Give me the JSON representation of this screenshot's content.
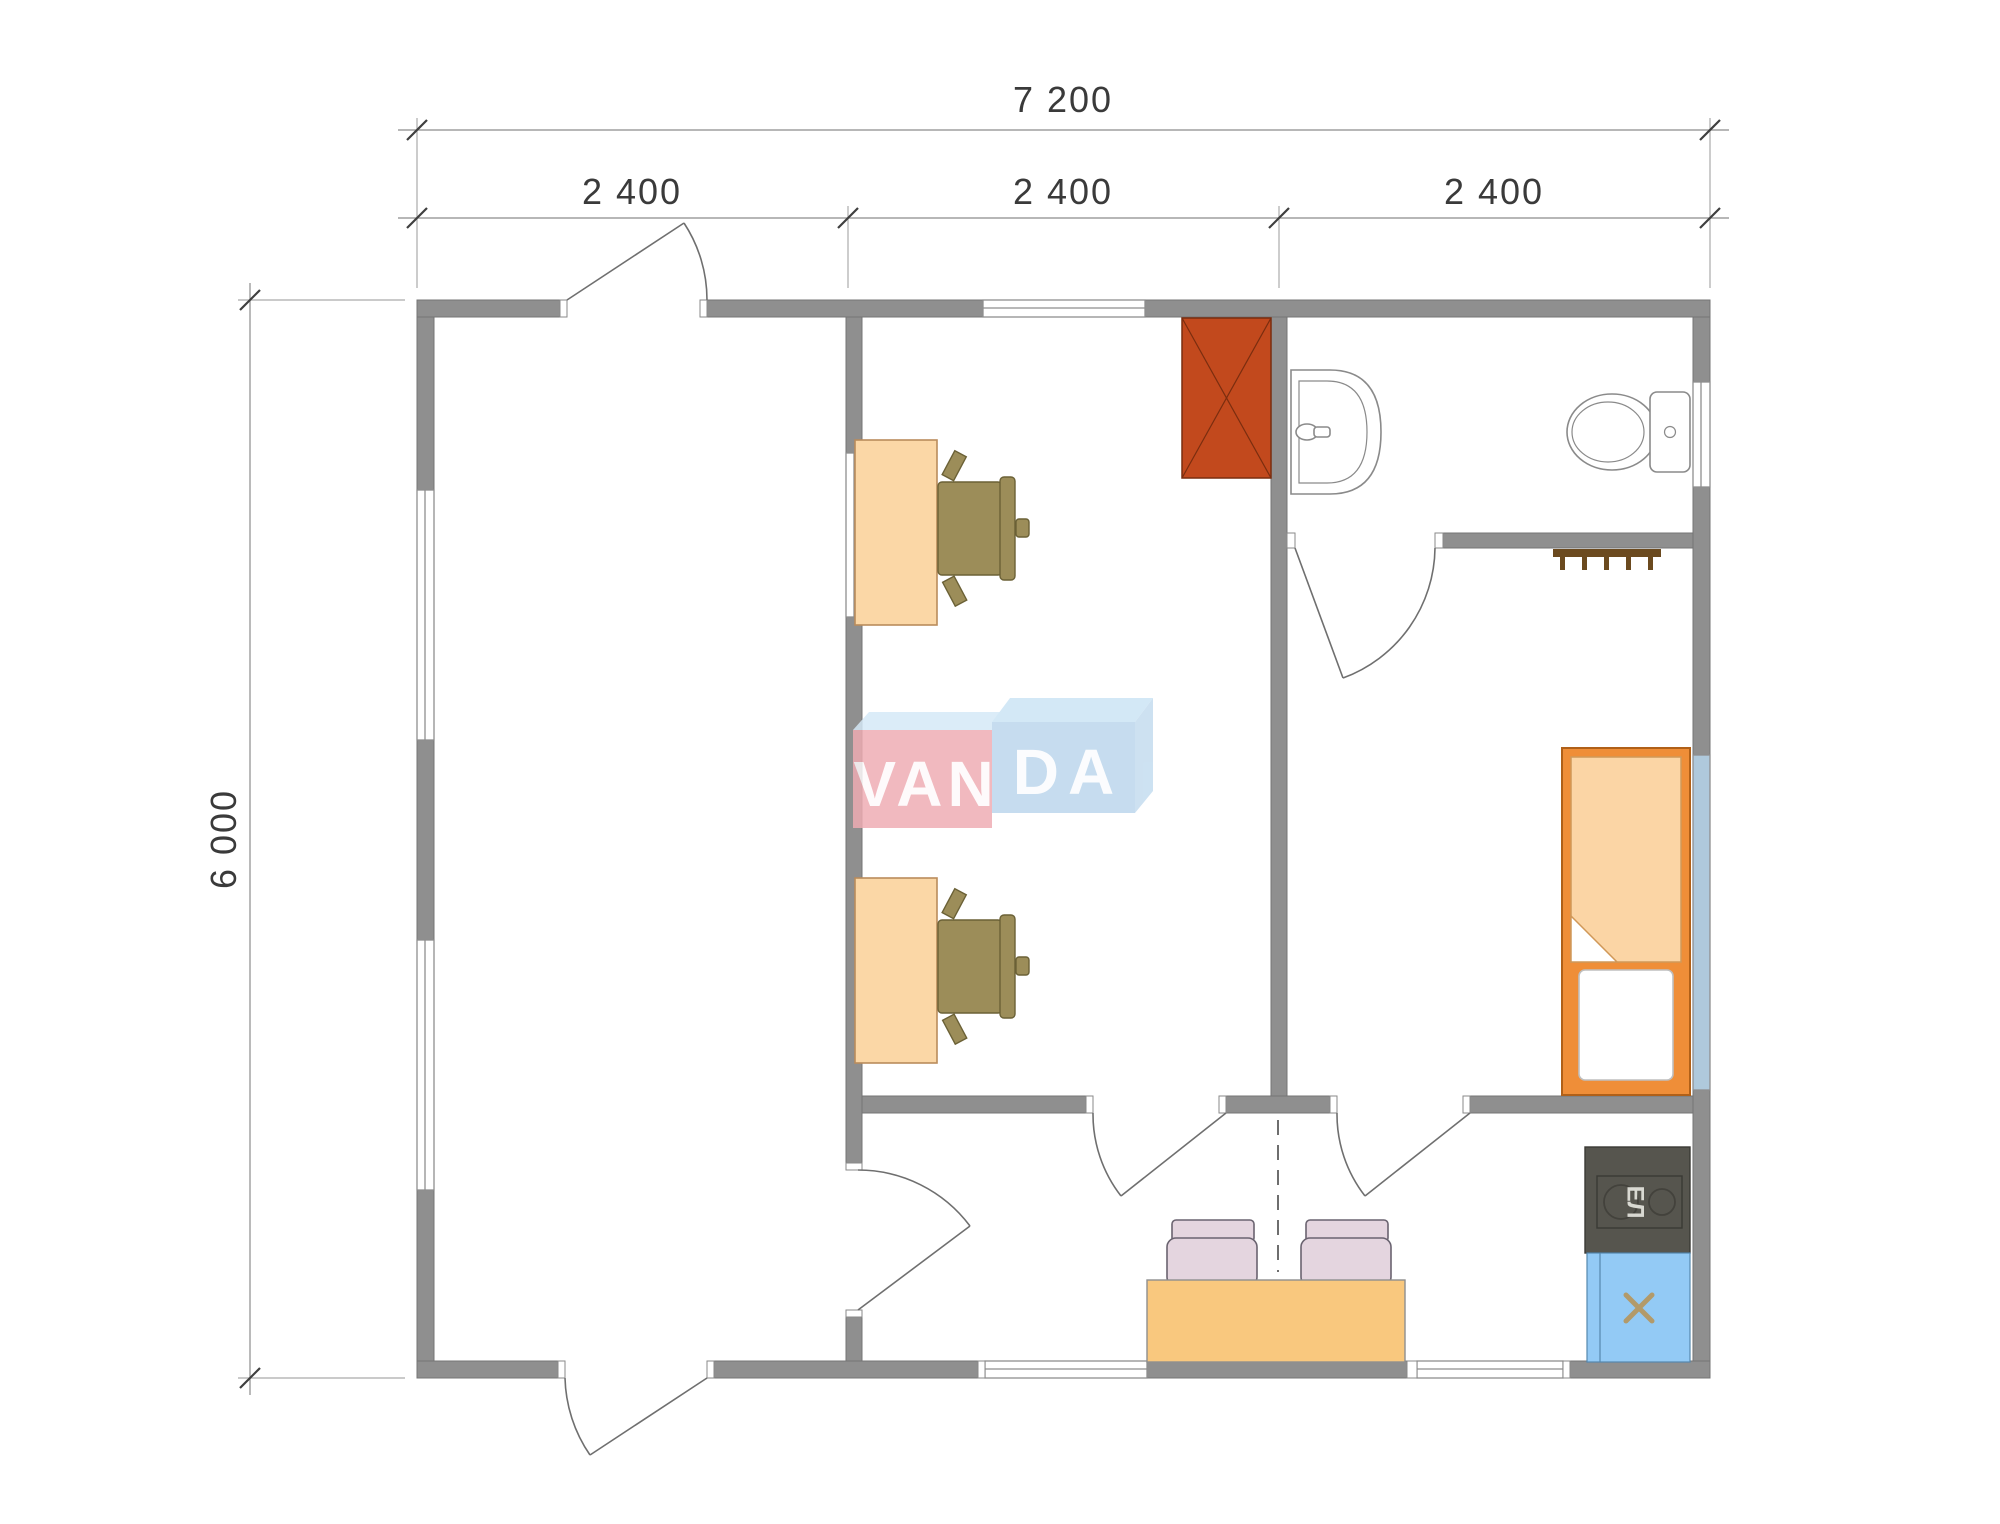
{
  "plan": {
    "dimensions": {
      "total_width": "7 200",
      "bay_1": "2 400",
      "bay_2": "2 400",
      "bay_3": "2 400",
      "total_height": "6 000"
    },
    "appliances": {
      "stove_label": "ЕЛ"
    }
  },
  "watermark": {
    "text_left": "VAN",
    "text_right": "DA"
  },
  "colors": {
    "wall": "#8F8F8F",
    "wall_edge": "#747474",
    "window_line": "#8E8E8E",
    "bed_window": "#AFC9DC",
    "door": "#6F6F6F",
    "dim_line": "#8C8C8C",
    "tick": "#3F3F3F",
    "desk": "#FBD7A6",
    "desk_edge": "#BA8C5C",
    "chair": "#9C8D59",
    "chair_edge": "#6B6136",
    "wardrobe": "#C2491D",
    "wardrobe_edge": "#7A2D0F",
    "fixture_line": "#8A8A8A",
    "rack": "#6B4A1F",
    "bed_frame": "#EF8E38",
    "bed_frame_edge": "#B06018",
    "blanket": "#FBD5A5",
    "blanket_edge": "#D09858",
    "pillow_edge": "#BFBFBF",
    "table": "#F9C87E",
    "table_edge": "#8F8F8F",
    "dining_chair": "#E4D5DF",
    "dining_chair_edge": "#6A6370",
    "stove": "#56554E",
    "stove_line": "#3B3A35",
    "burner_line": "#43423C",
    "stove_text": "#D9D9D2",
    "kitchen_sink": "#93CAF5",
    "kitchen_sink_edge": "#5588AE",
    "sink_x": "#B29A6A",
    "watermark_pink": "#EFACB3",
    "watermark_blue": "#BCD6EC",
    "watermark_top_left": "#D5E9F7",
    "watermark_top_right": "#CBE4F5",
    "watermark_side": "#C4DCEF"
  }
}
